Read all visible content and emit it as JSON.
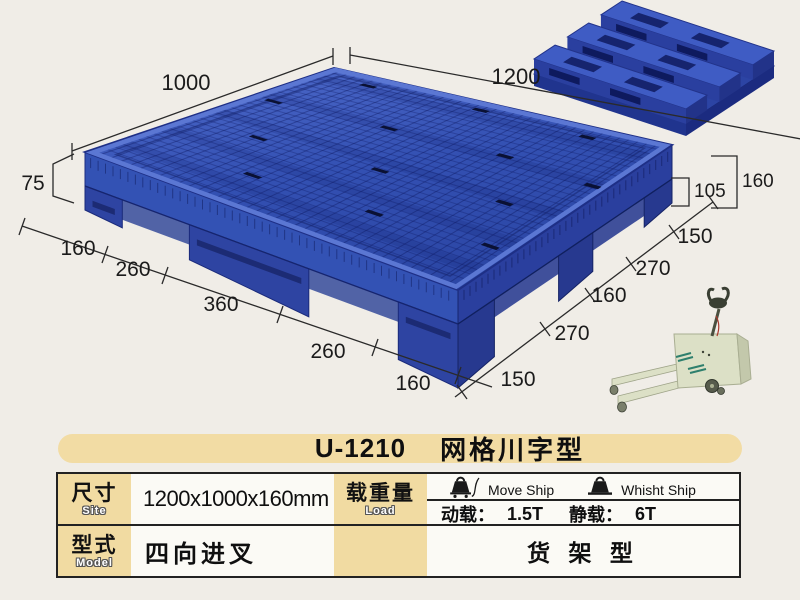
{
  "title": {
    "model": "U-1210",
    "name": "网格川字型"
  },
  "diagram": {
    "dim_top_left": "1000",
    "dim_top_right": "1200",
    "dim_height_left": "75",
    "dim_height_lower": "105",
    "dim_height_total": "160",
    "left_chain": [
      "160",
      "260",
      "360",
      "260",
      "160"
    ],
    "right_chain": [
      "150",
      "270",
      "160",
      "270",
      "150"
    ]
  },
  "table": {
    "size_label_cn": "尺寸",
    "size_label_en": "Site",
    "size_value": "1200x1000x160mm",
    "load_label_cn": "载重量",
    "load_label_en": "Load",
    "move_ship_label": "Move Ship",
    "whisht_ship_label": "Whisht Ship",
    "dynamic_load_label": "动载：",
    "dynamic_load_value": "1.5T",
    "static_load_label": "静载：",
    "static_load_value": "6T",
    "model_label_cn": "型式",
    "model_label_en": "Model",
    "model_value": "四向进叉",
    "rack_type": "货 架 型"
  },
  "icons": {
    "move_ship_icon": "weight-on-cart",
    "whisht_ship_icon": "weight-on-base"
  },
  "colors": {
    "pallet_blue": "#3352b4",
    "pallet_blue_dark": "#1e2f86",
    "accent_tan": "#f2dca4",
    "background": "#f0ede7",
    "truck_body": "#dce0c6"
  }
}
